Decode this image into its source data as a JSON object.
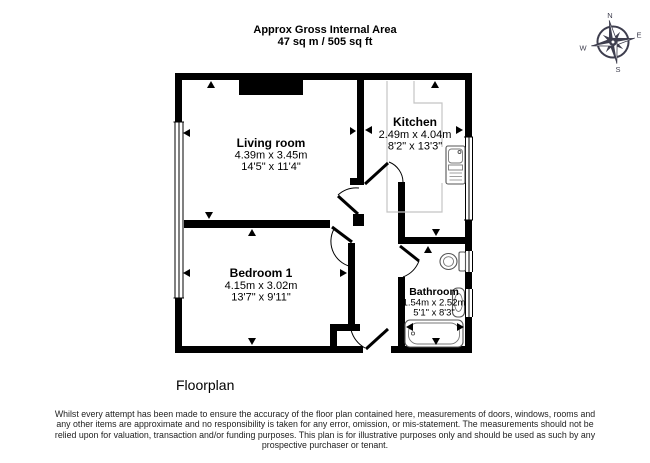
{
  "header": {
    "title": "Approx Gross Internal Area",
    "subtitle": "47 sq m / 505 sq ft"
  },
  "compass": {
    "north": "N",
    "east": "E",
    "south": "S",
    "west": "W"
  },
  "rooms": {
    "living_room": {
      "name": "Living room",
      "metric": "4.39m x 3.45m",
      "imperial": "14'5\" x 11'4\""
    },
    "kitchen": {
      "name": "Kitchen",
      "metric": "2.49m x 4.04m",
      "imperial": "8'2\" x 13'3\""
    },
    "bedroom": {
      "name": "Bedroom 1",
      "metric": "4.15m x 3.02m",
      "imperial": "13'7\" x 9'11\""
    },
    "bathroom": {
      "name": "Bathroom",
      "metric": "1.54m x 2.52m",
      "imperial": "5'1\" x 8'3\""
    }
  },
  "plan_label": "Floorplan",
  "disclaimer": {
    "lines": [
      "Whilst every attempt has been made to ensure the accuracy of the floor plan contained here, measurements of doors, windows, rooms and",
      "any other items are approximate and no responsibility is taken for any error, omission, or mis-statement. The measurements should not be",
      "relied upon for valuation, transaction and/or funding purposes. This plan is for illustrative purposes only and should be used as such by any",
      "prospective purchaser or tenant."
    ]
  },
  "colors": {
    "wall": "#000000",
    "compass": "#3e3e4e",
    "counter": "#c4c4c4"
  }
}
